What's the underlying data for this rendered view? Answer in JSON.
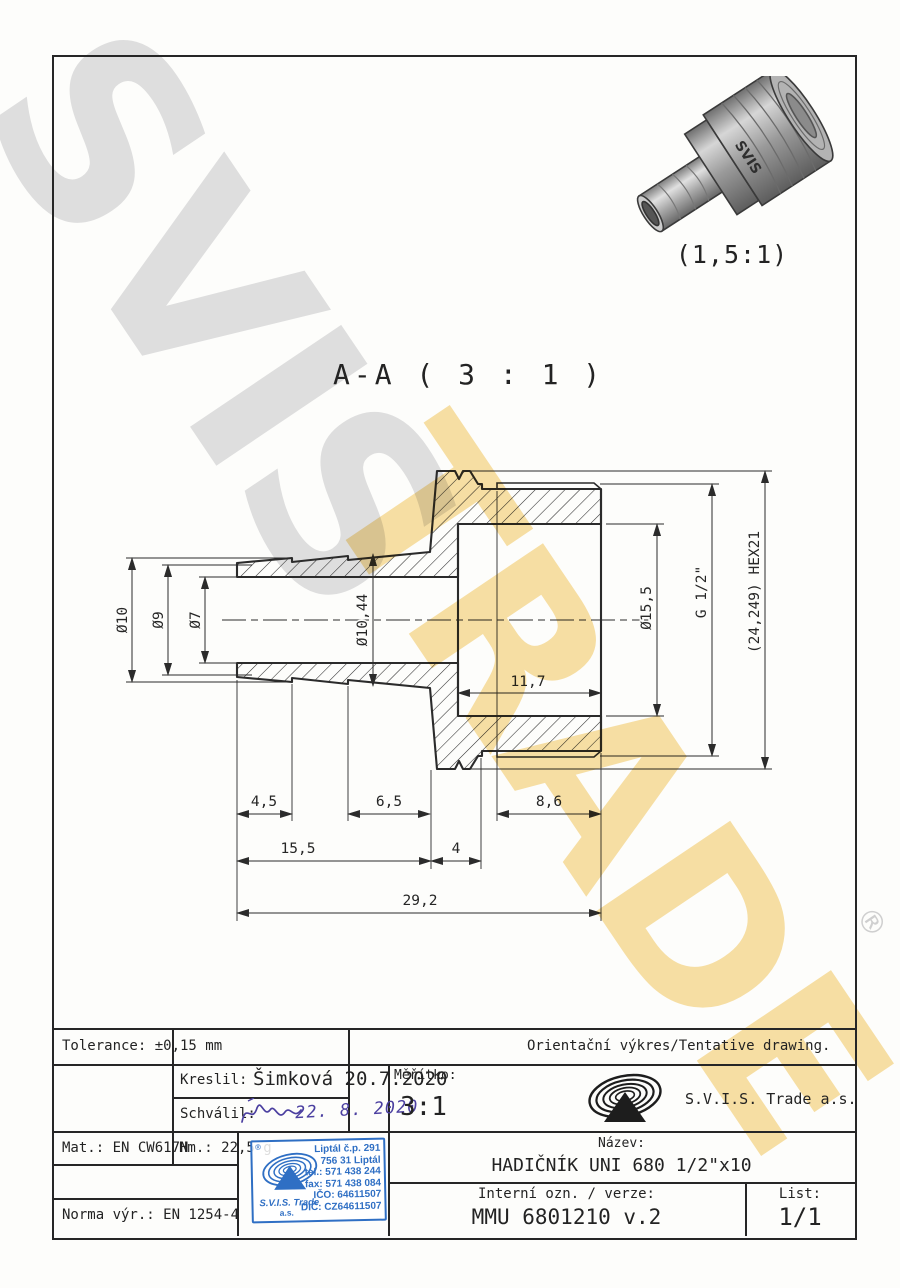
{
  "watermark": {
    "line1": "SVIS",
    "line2": "TRADE",
    "registered": "®"
  },
  "render_view": {
    "scale_label": "(1,5:1)",
    "brand_on_part": "SVIS"
  },
  "section_view": {
    "label": "A-A ( 3 : 1 )",
    "dimensions": {
      "d10": "Ø10",
      "d9": "Ø9",
      "d7": "Ø7",
      "d1044": "Ø10,44",
      "d155dia": "Ø15,5",
      "g12": "G 1/2\"",
      "hex": "(24,249) HEX21",
      "d117": "11,7",
      "d45": "4,5",
      "d65": "6,5",
      "d86": "8,6",
      "d155": "15,5",
      "d4": "4",
      "d292": "29,2"
    }
  },
  "title_block": {
    "tolerance": "Tolerance: ±0,15 mm",
    "orientacni": "Orientační výkres/Tentative drawing.",
    "kreslil_label": "Kreslil:",
    "kreslil_value": "Šimková 20.7.2020",
    "schvalil_label": "Schválil:",
    "schvalil_date": "22. 8. 2020",
    "meritko_label": "Měřítko:",
    "meritko_value": "3:1",
    "company": "S.V.I.S. Trade a.s.",
    "mat": "Mat.: EN CW617N",
    "hm": "Hm.: 22,5 g",
    "norma": "Norma výr.: EN 1254-4",
    "nazev_label": "Název:",
    "nazev_value": "HADIČNÍK UNI 680 1/2\"x10",
    "interni_label": "Interní ozn. / verze:",
    "interni_value": "MMU 6801210 v.2",
    "list_label": "List:",
    "list_value": "1/1"
  },
  "stamp": {
    "registered": "®",
    "line1": "Liptál č.p. 291",
    "line2": "756 31 Liptál",
    "line3": "tel.: 571 438 244",
    "line4": "fax: 571 438 084",
    "line5": "IČO: 64611507",
    "line6": "DIČ: CZ64611507",
    "company": "S.V.I.S. Trade",
    "suffix": "a.s."
  }
}
